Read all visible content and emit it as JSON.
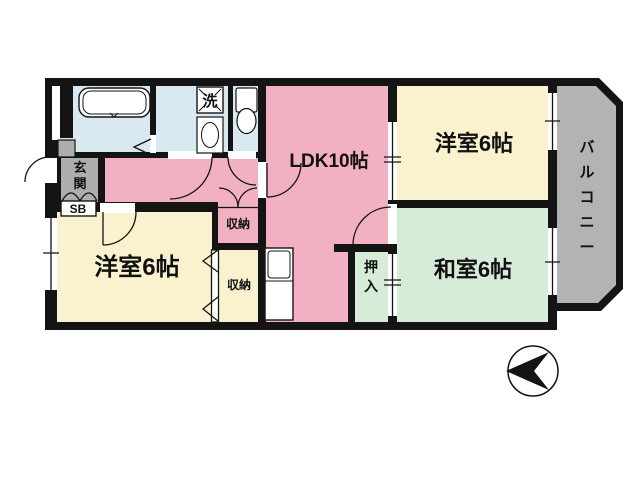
{
  "plan": {
    "rooms": {
      "ldk": {
        "label": "LDK10帖"
      },
      "western_room_upper": {
        "label": "洋室6帖"
      },
      "western_room_lower": {
        "label": "洋室6帖"
      },
      "japanese_room": {
        "label": "和室6帖"
      },
      "balcony": {
        "label": "バルコニー"
      },
      "entrance": {
        "label": "玄関"
      },
      "shoe_box": {
        "label": "SB"
      },
      "storage_upper": {
        "label": "収納"
      },
      "storage_lower": {
        "label": "収納"
      },
      "closet": {
        "label": "押入"
      },
      "washer": {
        "label": "洗"
      }
    },
    "colors": {
      "wall": "#141414",
      "ldk_pink": "#f2b0c3",
      "western_cream": "#faf2cf",
      "japanese_green": "#d6ecd9",
      "wet_blue": "#d8e9f1",
      "balcony_gray": "#b3b3b3",
      "entrance_gray": "#aeaeae",
      "fixture_white": "#ffffff"
    }
  }
}
